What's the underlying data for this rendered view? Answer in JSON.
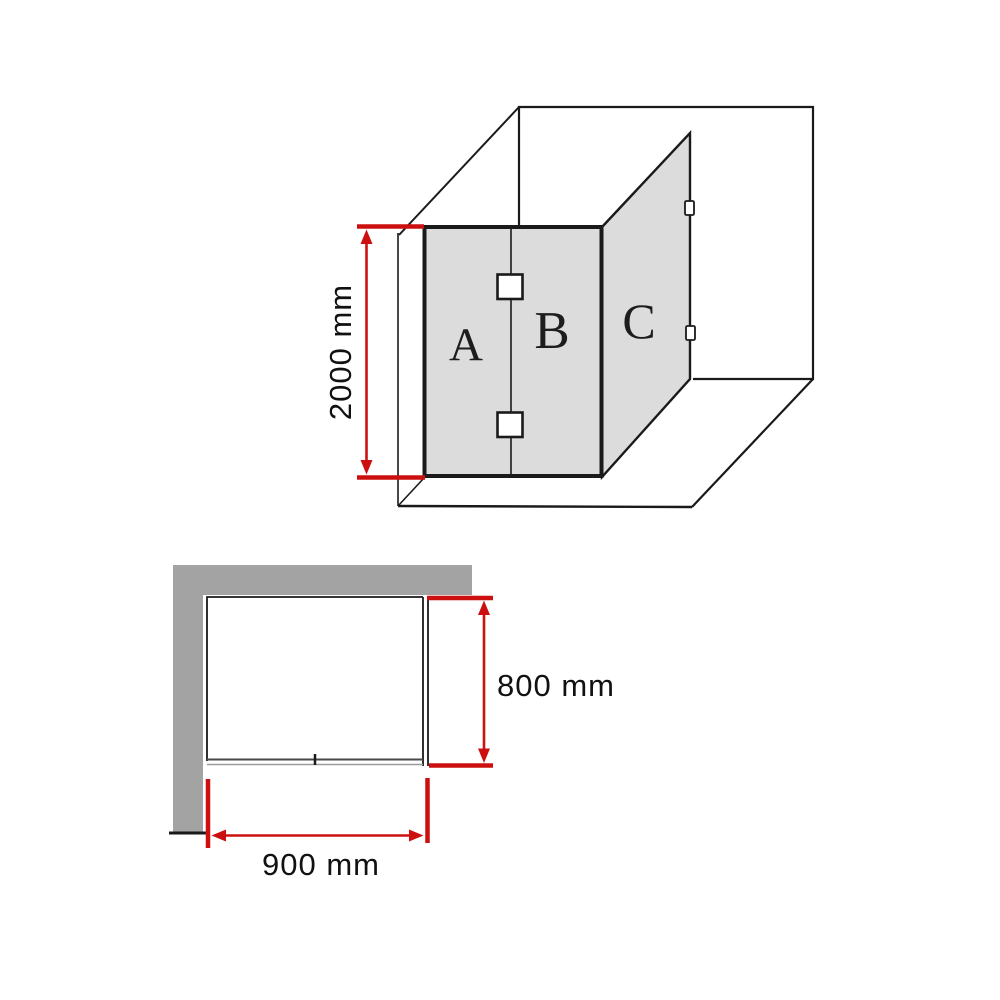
{
  "diagram": {
    "kind": "shower-screen-dimension-diagram",
    "isometric_view": {
      "panels": [
        {
          "label": "A"
        },
        {
          "label": "B"
        },
        {
          "label": "C"
        }
      ],
      "height_dimension": {
        "label": "2000 mm"
      }
    },
    "plan_view": {
      "depth_dimension": {
        "label": "800 mm"
      },
      "width_dimension": {
        "label": "900 mm"
      }
    },
    "colors": {
      "dimension_red": "#cc1010",
      "glass_panel_fill": "#dcdcdc",
      "wall_fill": "#a3a3a3",
      "line": "#1a1a1a",
      "background": "#ffffff"
    }
  }
}
